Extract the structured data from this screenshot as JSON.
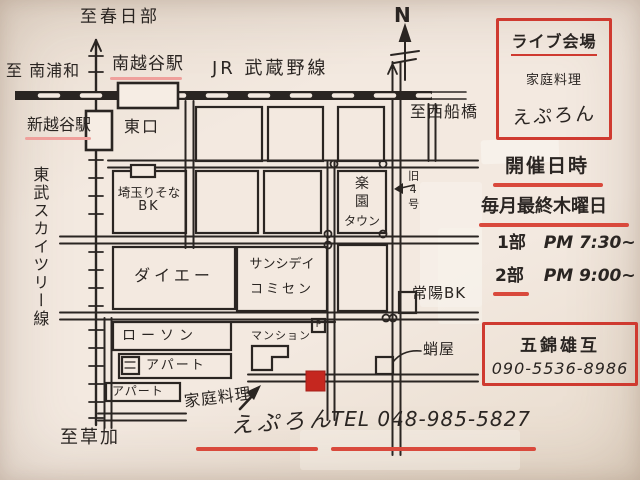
{
  "colors": {
    "ink": "#2a2522",
    "red": "#cf3a30",
    "pink_underline": "#efa09c",
    "marker_red": "#c5271f",
    "paper": "#f3e9e0"
  },
  "compass": {
    "label": "N"
  },
  "railways": {
    "jr": "JR 武蔵野線",
    "tobu": "東武スカイツリー線"
  },
  "destinations": {
    "kasukabe": "至春日部",
    "minami_urawa": "至 南浦和",
    "nishi_funabashi": "至西船橋",
    "soka": "至草加"
  },
  "stations": {
    "minami_koshigaya": "南越谷駅",
    "shin_koshigaya": "新越谷駅",
    "east_exit": "東口"
  },
  "roads": {
    "old_route_4": "旧4号"
  },
  "landmarks": {
    "resona_line1": "埼玉りそな",
    "resona_line2": "BK",
    "daiei": "ダイエー",
    "comcen_line1": "サンシデイ",
    "comcen_line2": "コミセン",
    "rakuen_line1": "楽",
    "rakuen_line2": "園",
    "rakuen_line3": "タウン",
    "lawson": "ローソン",
    "mansion": "マンション",
    "parking": "P",
    "apartment_1": "アパート",
    "apartment_2": "アパート",
    "joyo_bank": "常陽BK",
    "takoya": "蛸屋"
  },
  "venue_box": {
    "heading": "ライブ会場",
    "line1": "家庭料理",
    "line2": "えぷろん"
  },
  "schedule": {
    "heading": "開催日時",
    "frequency": "毎月最終木曜日",
    "part1_label": "1部",
    "part1_time": "PM 7:30~",
    "part2_label": "2部",
    "part2_time": "PM 9:00~"
  },
  "contact_box": {
    "name": "五錦雄互",
    "phone": "090-5536-8986"
  },
  "footer": {
    "type": "家庭料理",
    "name": "えぷろん",
    "tel": "TEL 048-985-5827"
  }
}
